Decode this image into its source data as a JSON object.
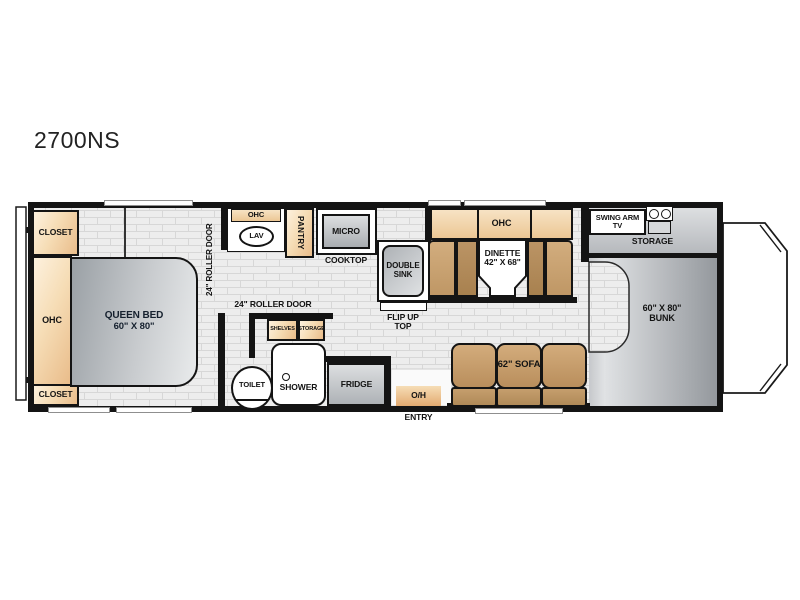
{
  "title": "2700NS",
  "colors": {
    "wall": "#141414",
    "cabinet_light": "#fdf1de",
    "cabinet_dark": "#e9bc8a",
    "bench_brown": "#b08a58",
    "sofa_brown": "#bf9765",
    "fixture_gray_light": "#eceeef",
    "fixture_gray_dark": "#9aa0a5",
    "floor": "#ededed",
    "floor_line": "#d7d7d7"
  },
  "bedroom": {
    "closet_top": "CLOSET",
    "ohc": "OHC",
    "closet_bottom": "CLOSET",
    "bed_line1": "QUEEN BED",
    "bed_line2": "60\" X 80\"",
    "roller_door_vertical": "24\" ROLLER DOOR"
  },
  "bath": {
    "roller_door": "24\" ROLLER DOOR",
    "ohc": "OHC",
    "lav": "LAV",
    "shelves": "SHELVES",
    "storage": "STORAGE",
    "toilet": "TOILET",
    "shower": "SHOWER"
  },
  "kitchen": {
    "pantry": "PANTRY",
    "micro": "MICRO",
    "cooktop": "COOKTOP",
    "sink_line1": "DOUBLE",
    "sink_line2": "SINK",
    "flip_line1": "FLIP UP",
    "flip_line2": "TOP",
    "fridge": "FRIDGE"
  },
  "dinette": {
    "ohc": "OHC",
    "name": "DINETTE",
    "size": "42\" X 68\""
  },
  "living": {
    "sofa": "62\" SOFA",
    "entry_line1": "O/H",
    "entry_line2": "ENTRY"
  },
  "front": {
    "tv_line1": "SWING ARM",
    "tv_line2": "TV",
    "storage": "STORAGE",
    "bunk_line1": "60\" X 80\"",
    "bunk_line2": "BUNK"
  }
}
